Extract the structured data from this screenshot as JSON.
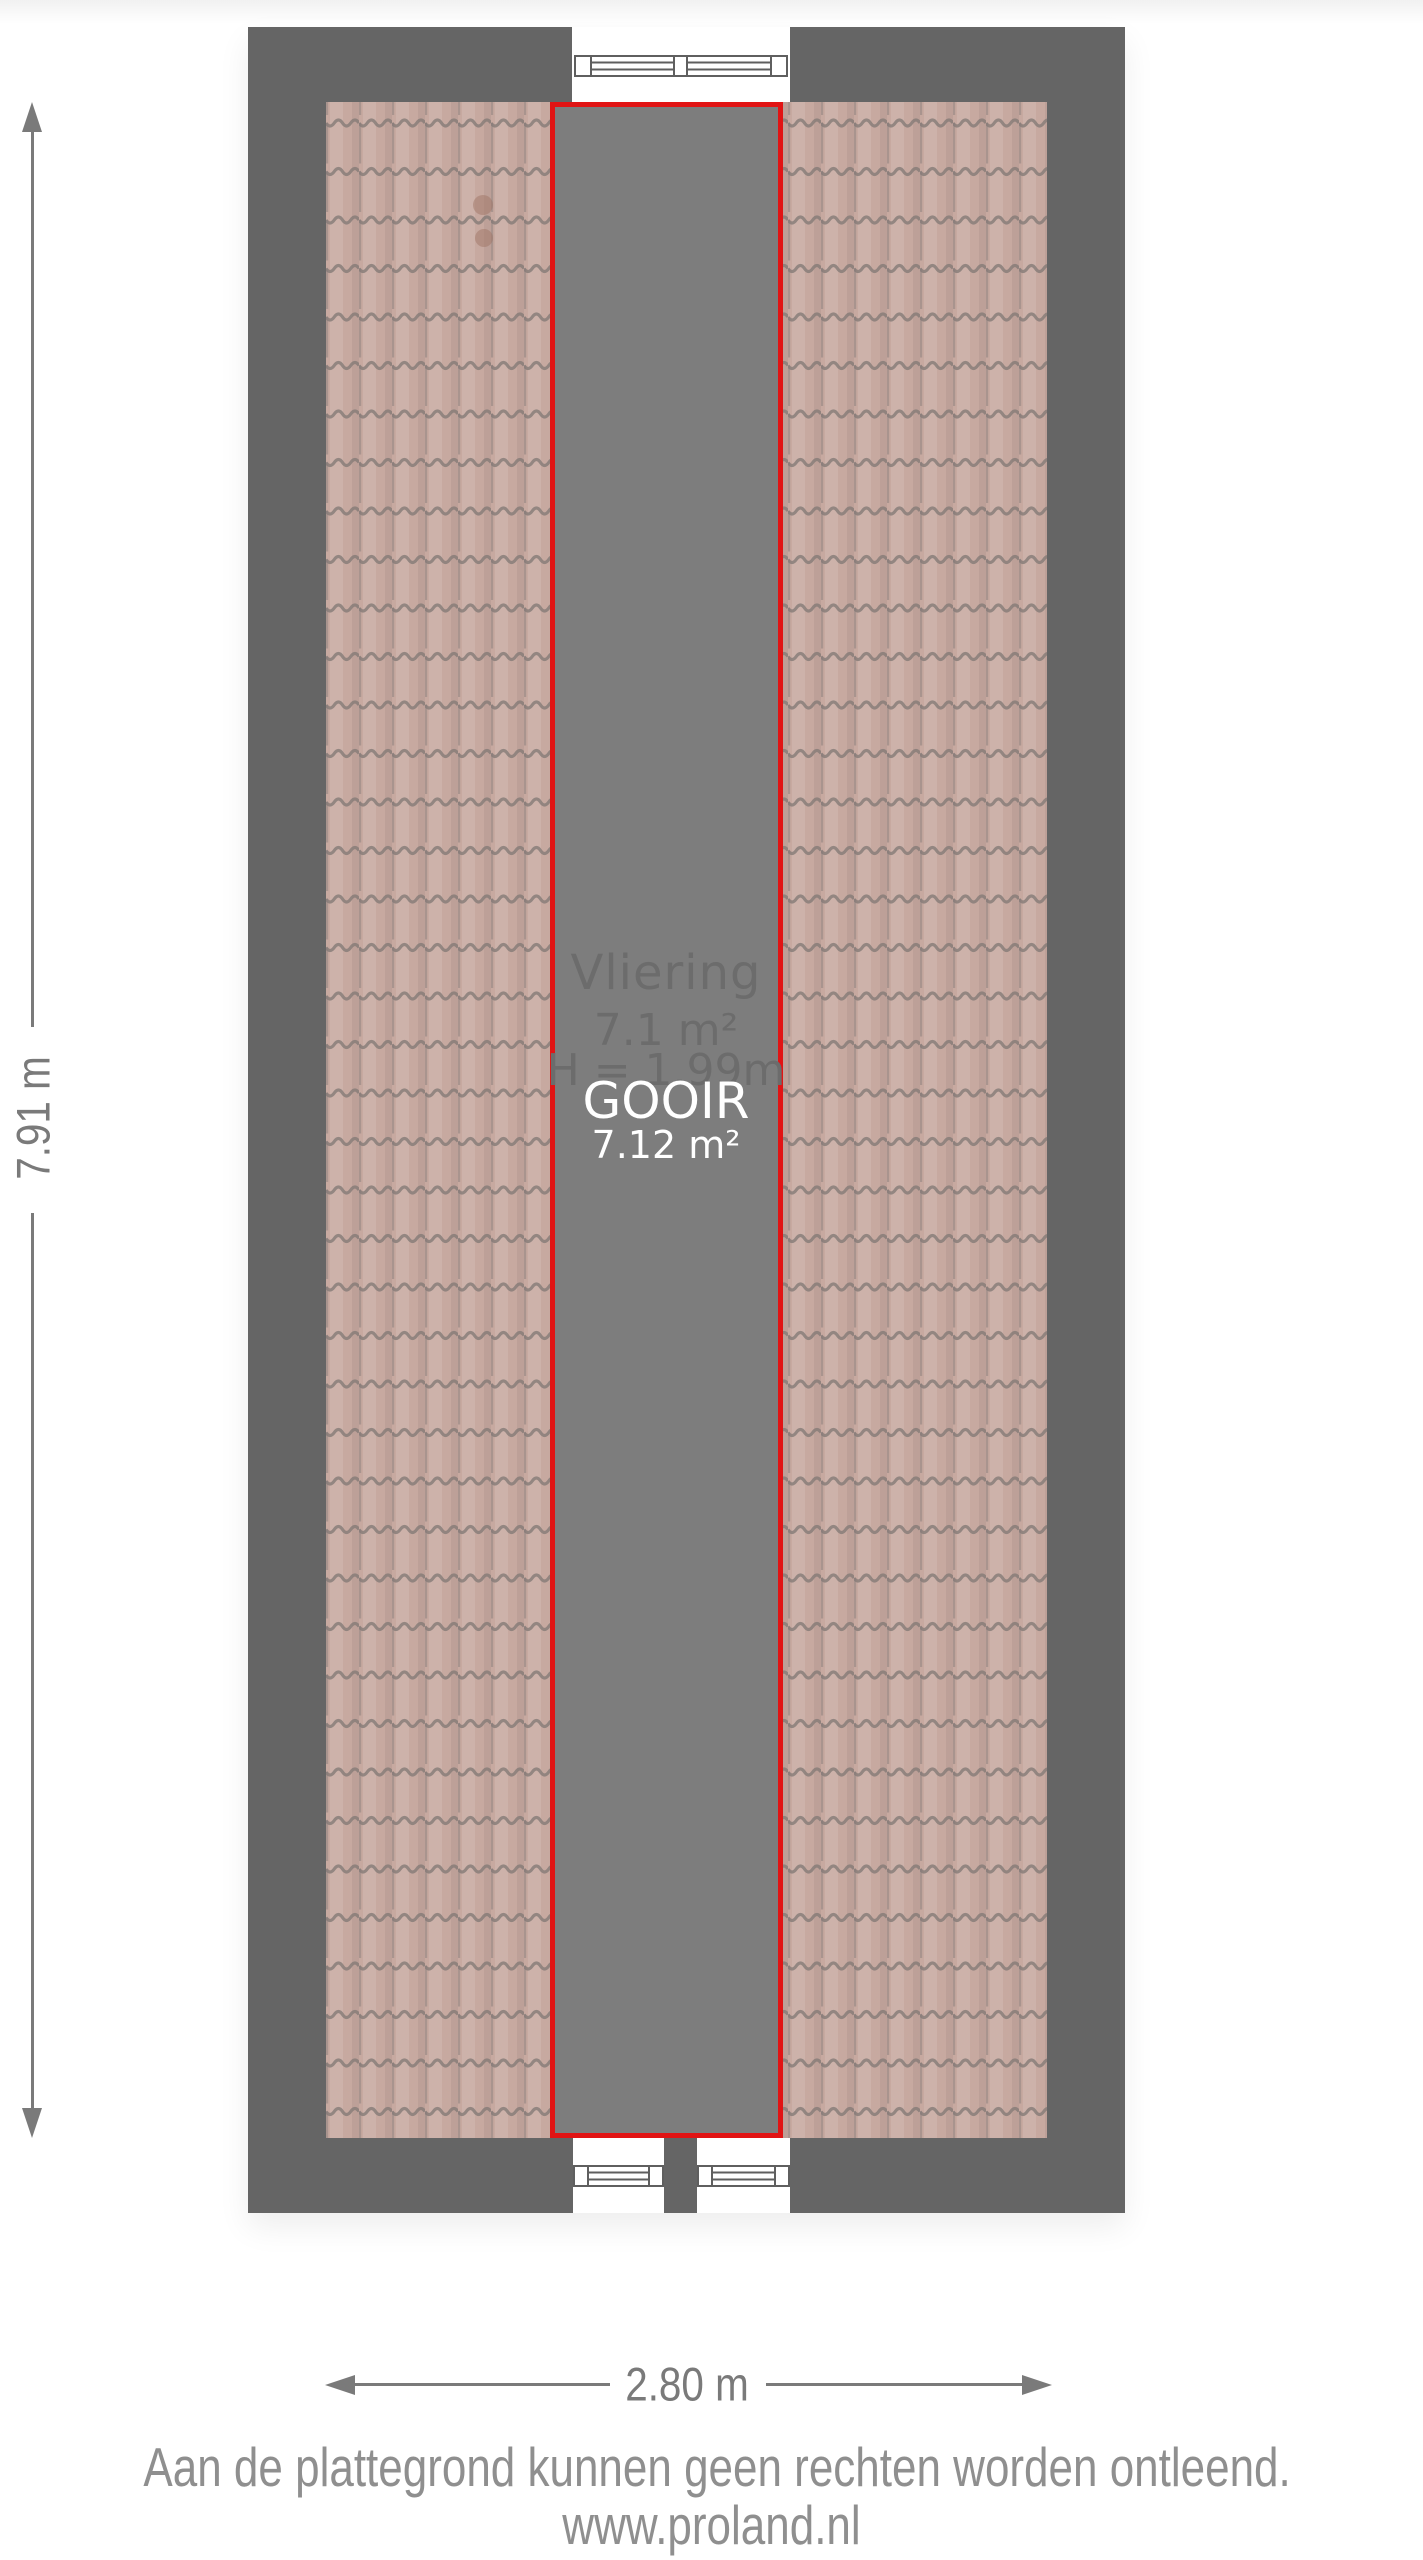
{
  "plan": {
    "room": {
      "name": "Vliering",
      "area": "7.1 m²",
      "height_label": "H = 1.99m"
    },
    "marker": {
      "name": "GOOIR",
      "area": "7.12 m²"
    },
    "dimensions": {
      "height": "7.91 m",
      "width": "2.80 m"
    }
  },
  "footer": {
    "disclaimer": "Aan de plattegrond kunnen geen rechten worden ontleend.",
    "website": "www.proland.nl"
  },
  "colors": {
    "wall": "#656565",
    "attic_floor": "#7d7d7d",
    "roof_tiles": "#c7a9a0",
    "roof_tile_lines": "#857a77",
    "marker_border": "#e11414",
    "dimension_lines": "#7a7a7a",
    "room_label": "#6c6c6c",
    "marker_label": "#ffffff",
    "footer_text": "#8f8f8f",
    "window_outline": "#5f5f5f"
  }
}
